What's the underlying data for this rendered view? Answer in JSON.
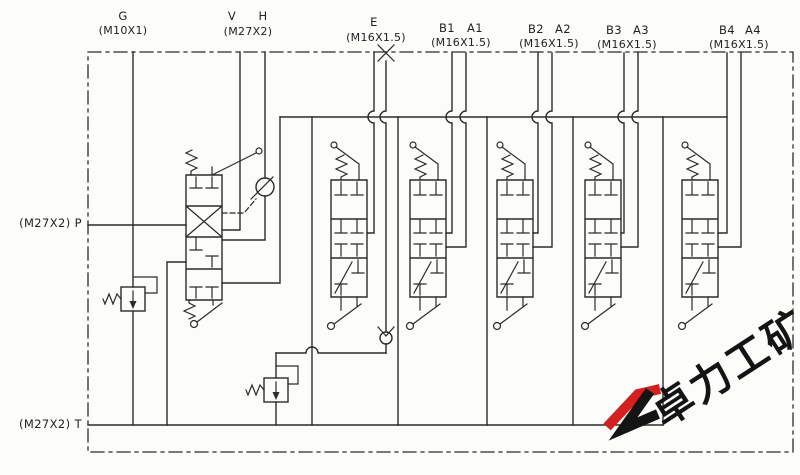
{
  "diagram": {
    "kind": "hydraulic-valve-schematic",
    "ports": {
      "g": "G",
      "g_thread": "(M10X1)",
      "v": "V",
      "h": "H",
      "vh_thread": "(M27X2)",
      "e": "E",
      "e_thread": "(M16X1.5)",
      "b1": "B1",
      "a1": "A1",
      "b1a1_thread": "(M16X1.5)",
      "b2": "B2",
      "a2": "A2",
      "b2a2_thread": "(M16X1.5)",
      "b3": "B3",
      "a3": "A3",
      "b3a3_thread": "(M16X1.5)",
      "b4": "B4",
      "a4": "A4",
      "b4a4_thread": "(M16X1.5)",
      "p": "(M27X2) P",
      "t": "(M27X2) T"
    }
  },
  "watermark": {
    "text": "卓力工矿"
  },
  "colors": {
    "line": "#2b2b2b",
    "paper": "#fcfcfa",
    "watermark_red": "#d42020",
    "watermark_black": "#141414"
  }
}
